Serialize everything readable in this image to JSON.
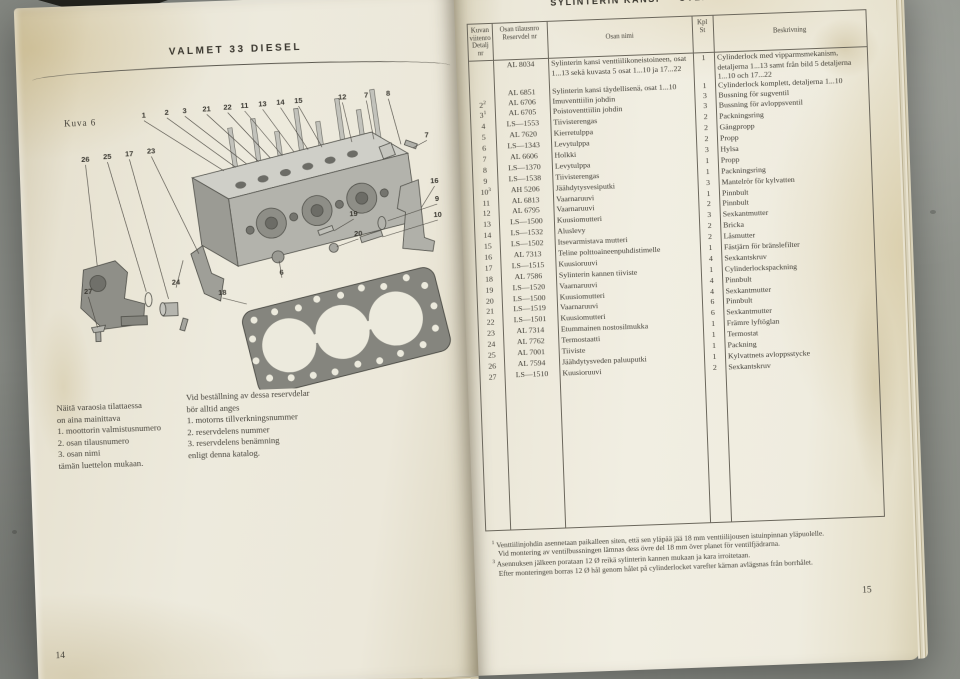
{
  "left_page": {
    "title": "VALMET 33 DIESEL",
    "figure_label": "Kuva 6",
    "page_number": "14",
    "ordering_note_fi": [
      "Näitä varaosia tilattaessa",
      "on aina mainittava",
      "1. moottorin valmistusnumero",
      "2. osan tilausnumero",
      "3. osan nimi",
      "tämän luettelon mukaan."
    ],
    "ordering_note_sv": [
      "Vid beställning av dessa reservdelar",
      "bör alltid anges",
      "1. motorns tillverkningsnummer",
      "2. reservdelens nummer",
      "3. reservdelens benämning",
      "enligt denna katalog."
    ],
    "callouts": [
      {
        "label": "1",
        "x": 118,
        "y": 26,
        "tx": 196,
        "ty": 82
      },
      {
        "label": "2",
        "x": 141,
        "y": 24,
        "tx": 208,
        "ty": 79
      },
      {
        "label": "3",
        "x": 159,
        "y": 23,
        "tx": 219,
        "ty": 76
      },
      {
        "label": "21",
        "x": 181,
        "y": 22,
        "tx": 231,
        "ty": 74
      },
      {
        "label": "22",
        "x": 202,
        "y": 21,
        "tx": 243,
        "ty": 71
      },
      {
        "label": "11",
        "x": 219,
        "y": 20,
        "tx": 255,
        "ty": 69
      },
      {
        "label": "13",
        "x": 237,
        "y": 19,
        "tx": 267,
        "ty": 66
      },
      {
        "label": "14",
        "x": 255,
        "y": 18,
        "tx": 281,
        "ty": 64
      },
      {
        "label": "15",
        "x": 273,
        "y": 17,
        "tx": 295,
        "ty": 62
      },
      {
        "label": "12",
        "x": 317,
        "y": 15,
        "tx": 325,
        "ty": 58
      },
      {
        "label": "7",
        "x": 341,
        "y": 14,
        "tx": 347,
        "ty": 56
      },
      {
        "label": "8",
        "x": 363,
        "y": 13,
        "tx": 374,
        "ty": 62
      },
      {
        "label": "26",
        "x": 58,
        "y": 68,
        "tx": 66,
        "ty": 172
      },
      {
        "label": "25",
        "x": 80,
        "y": 66,
        "tx": 114,
        "ty": 200
      },
      {
        "label": "17",
        "x": 102,
        "y": 64,
        "tx": 136,
        "ty": 208
      },
      {
        "label": "23",
        "x": 124,
        "y": 62,
        "tx": 168,
        "ty": 164
      },
      {
        "label": "7",
        "x": 400,
        "y": 56,
        "tx": 386,
        "ty": 66
      },
      {
        "label": "16",
        "x": 406,
        "y": 102,
        "tx": 392,
        "ty": 126
      },
      {
        "label": "9",
        "x": 408,
        "y": 120,
        "tx": 358,
        "ty": 138
      },
      {
        "label": "10",
        "x": 408,
        "y": 136,
        "tx": 352,
        "ty": 154
      },
      {
        "label": "19",
        "x": 324,
        "y": 132,
        "tx": 304,
        "ty": 146
      },
      {
        "label": "20",
        "x": 328,
        "y": 152,
        "tx": 306,
        "ty": 162
      },
      {
        "label": "6",
        "x": 250,
        "y": 188,
        "tx": 248,
        "ty": 174
      },
      {
        "label": "27",
        "x": 56,
        "y": 200,
        "tx": 64,
        "ty": 234
      },
      {
        "label": "24",
        "x": 144,
        "y": 194,
        "tx": 152,
        "ty": 170
      },
      {
        "label": "18",
        "x": 190,
        "y": 206,
        "tx": 214,
        "ty": 216
      }
    ]
  },
  "right_page": {
    "title": "SYLINTERIN KANSI — CYLINDERLOCK",
    "page_number": "15",
    "table": {
      "headers": {
        "ref_1": "Kuvan",
        "ref_2": "viitenro",
        "ref_3": "Detalj nr",
        "part_1": "Osan tilausnro",
        "part_2": "Reservdel nr",
        "name": "Osan nimi",
        "qty_1": "Kpl",
        "qty_2": "St",
        "desc": "Beskrivning"
      },
      "rows": [
        {
          "ref": "",
          "sup": "",
          "part": "AL 8034",
          "fi": "Sylinterin kansi venttiilikoneistoineen, osat 1...13 sekä kuvasta 5 osat 1...10 ja 17...22",
          "qty": "1",
          "sv": "Cylinderlock med vipparmsmekanism, detaljerna 1...13 samt från bild 5 detaljerna 1...10 och 17...22"
        },
        {
          "ref": "",
          "sup": "",
          "part": "AL 6851",
          "fi": "Sylinterin kansi täydellisenä, osat 1...10",
          "qty": "1",
          "sv": "Cylinderlock komplett, detaljerna 1...10"
        },
        {
          "ref": "2",
          "sup": "2",
          "part": "AL 6706",
          "fi": "Imuventtiilin johdin",
          "qty": "3",
          "sv": "Bussning för sugventil"
        },
        {
          "ref": "3",
          "sup": "1",
          "part": "AL 6705",
          "fi": "Poistoventtiilin johdin",
          "qty": "3",
          "sv": "Bussning för avloppsventil"
        },
        {
          "ref": "4",
          "sup": "",
          "part": "LS—1553",
          "fi": "Tiivisterengas",
          "qty": "2",
          "sv": "Packningsring"
        },
        {
          "ref": "5",
          "sup": "",
          "part": "AL 7620",
          "fi": "Kierretulppa",
          "qty": "2",
          "sv": "Gängpropp"
        },
        {
          "ref": "6",
          "sup": "",
          "part": "LS—1343",
          "fi": "Levytulppa",
          "qty": "2",
          "sv": "Propp"
        },
        {
          "ref": "7",
          "sup": "",
          "part": "AL 6606",
          "fi": "Holkki",
          "qty": "3",
          "sv": "Hylsa"
        },
        {
          "ref": "8",
          "sup": "",
          "part": "LS—1370",
          "fi": "Levytulppa",
          "qty": "1",
          "sv": "Propp"
        },
        {
          "ref": "9",
          "sup": "",
          "part": "LS—1538",
          "fi": "Tiivisterengas",
          "qty": "1",
          "sv": "Packningsring"
        },
        {
          "ref": "10",
          "sup": "3",
          "part": "AH 5206",
          "fi": "Jäähdytysvesiputki",
          "qty": "3",
          "sv": "Mantelrör för kylvatten"
        },
        {
          "ref": "11",
          "sup": "",
          "part": "AL 6813",
          "fi": "Vaarnaruuvi",
          "qty": "1",
          "sv": "Pinnbult"
        },
        {
          "ref": "12",
          "sup": "",
          "part": "AL 6795",
          "fi": "Vaarnaruuvi",
          "qty": "2",
          "sv": "Pinnbult"
        },
        {
          "ref": "13",
          "sup": "",
          "part": "LS—1500",
          "fi": "Kuusiomutteri",
          "qty": "3",
          "sv": "Sexkantmutter"
        },
        {
          "ref": "14",
          "sup": "",
          "part": "LS—1532",
          "fi": "Aluslevy",
          "qty": "2",
          "sv": "Bricka"
        },
        {
          "ref": "15",
          "sup": "",
          "part": "LS—1502",
          "fi": "Itsevarmistava mutteri",
          "qty": "2",
          "sv": "Låsmutter"
        },
        {
          "ref": "16",
          "sup": "",
          "part": "AL 7313",
          "fi": "Teline polttoaineenpuhdistimelle",
          "qty": "1",
          "sv": "Fästjärn för bränslefilter"
        },
        {
          "ref": "17",
          "sup": "",
          "part": "LS—1515",
          "fi": "Kuusioruuvi",
          "qty": "4",
          "sv": "Sexkantskruv"
        },
        {
          "ref": "18",
          "sup": "",
          "part": "AL 7586",
          "fi": "Sylinterin kannen tiiviste",
          "qty": "1",
          "sv": "Cylinderlockspackning"
        },
        {
          "ref": "19",
          "sup": "",
          "part": "LS—1520",
          "fi": "Vaarnaruuvi",
          "qty": "4",
          "sv": "Pinnbult"
        },
        {
          "ref": "20",
          "sup": "",
          "part": "LS—1500",
          "fi": "Kuusiomutteri",
          "qty": "4",
          "sv": "Sexkantmutter"
        },
        {
          "ref": "21",
          "sup": "",
          "part": "LS—1519",
          "fi": "Vaarnaruuvi",
          "qty": "6",
          "sv": "Pinnbult"
        },
        {
          "ref": "22",
          "sup": "",
          "part": "LS—1501",
          "fi": "Kuusiomutteri",
          "qty": "6",
          "sv": "Sexkantmutter"
        },
        {
          "ref": "23",
          "sup": "",
          "part": "AL 7314",
          "fi": "Etummainen nostosilmukka",
          "qty": "1",
          "sv": "Främre lyftöglan"
        },
        {
          "ref": "24",
          "sup": "",
          "part": "AL 7762",
          "fi": "Termostaatti",
          "qty": "1",
          "sv": "Termostat"
        },
        {
          "ref": "25",
          "sup": "",
          "part": "AL 7001",
          "fi": "Tiiviste",
          "qty": "1",
          "sv": "Packning"
        },
        {
          "ref": "26",
          "sup": "",
          "part": "AL 7594",
          "fi": "Jäähdytysveden paluuputki",
          "qty": "1",
          "sv": "Kylvattnets avloppsstycke"
        },
        {
          "ref": "27",
          "sup": "",
          "part": "LS—1510",
          "fi": "Kuusioruuvi",
          "qty": "2",
          "sv": "Sexkantskruv"
        }
      ]
    },
    "footnotes": [
      {
        "marker": "1",
        "fi": "Venttiilinjohdin asennetaan paikalleen siten, että sen yläpää jää 18 mm venttiilijousen istuinpinnan yläpuolelle.",
        "sv": "Vid montering av ventilbussningen lämnas dess övre del 18 mm över planet för ventilfjädrarna."
      },
      {
        "marker": "3",
        "fi": "Asennuksen jälkeen porataan 12 Ø reikä sylinterin kannen mukaan ja kara irroitetaan.",
        "sv": "Efter monteringen borras 12 Ø hål genom hålet på cylinderlocket varefter kärnan avlägsnas från borrhålet."
      }
    ]
  },
  "colors": {
    "page_cream": "#ece8da",
    "floor_gray": "#8f928c",
    "ink": "#3f3c34"
  }
}
